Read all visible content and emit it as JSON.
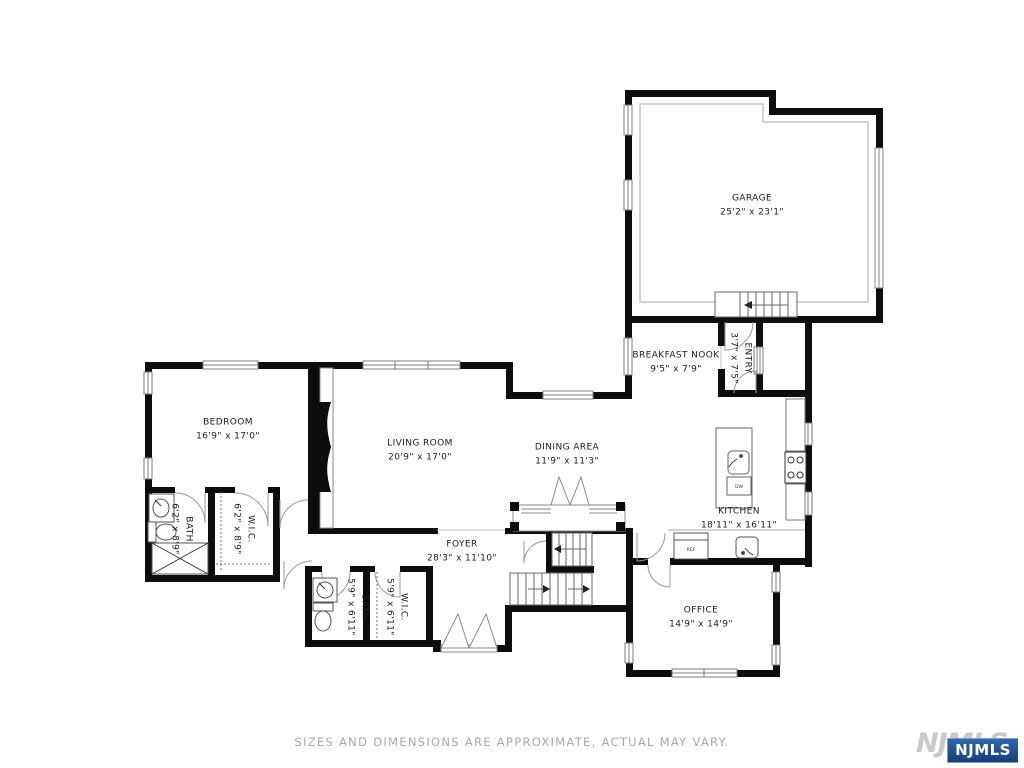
{
  "rooms": [
    {
      "name": "GARAGE",
      "dims": "25'2\" x 23'1\""
    },
    {
      "name": "BREAKFAST NOOK",
      "dims": "9'5\" x 7'9\""
    },
    {
      "name": "ENTRY",
      "dims": "3'7\" x 7'5\""
    },
    {
      "name": "BEDROOM",
      "dims": "16'9\" x 17'0\""
    },
    {
      "name": "LIVING ROOM",
      "dims": "20'9\" x 17'0\""
    },
    {
      "name": "DINING AREA",
      "dims": "11'9\" x 11'3\""
    },
    {
      "name": "KITCHEN",
      "dims": "18'11\" x 16'11\""
    },
    {
      "name": "BATH",
      "dims": "6'2\" x 8'9\""
    },
    {
      "name": "W.I.C.",
      "dims": "6'2\" x 8'9\""
    },
    {
      "name": "FOYER",
      "dims": "28'3\" x 11'10\""
    },
    {
      "name": "BATH",
      "dims": "5'9\" x 6'11\""
    },
    {
      "name": "W.I.C.",
      "dims": "5'9\" x 6'11\""
    },
    {
      "name": "OFFICE",
      "dims": "14'9\" x 14'9\""
    }
  ],
  "fixtures": {
    "ref": "REF",
    "dw": "DW"
  },
  "footer": {
    "disclaimer": "SIZES AND DIMENSIONS ARE APPROXIMATE, ACTUAL MAY VARY."
  },
  "logo": {
    "watermark": "NJMLS",
    "badge": "NJMLS"
  },
  "colors": {
    "wall": "#0d0d0d",
    "line": "#777777",
    "door": "#9a9a9a",
    "badge_blue": "#1b4a8a",
    "watermark_gray": "#c9c9c9"
  }
}
